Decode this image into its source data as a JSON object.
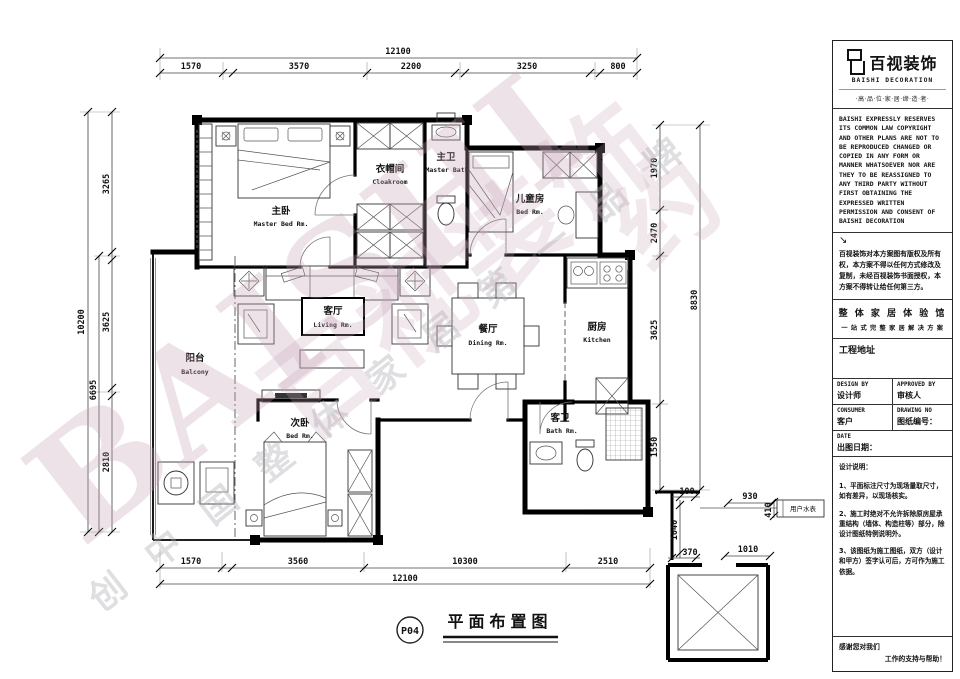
{
  "sheet": {
    "number": "P04",
    "title": "平面布置图"
  },
  "brand": {
    "logo_cn": "百视装饰",
    "logo_en": "BAISHI  DECORATION",
    "tagline": "·高·品·位·家·居·缔·造·者·",
    "copyright_en": "BAISHI EXPRESSLY RESERVES ITS COMMON LAW COPYRIGHT AND OTHER PLANS ARE NOT TO BE REPRODUCED CHANGED OR COPIED IN ANY FORM OR MANNER WHATSOEVER NOR ARE THEY TO BE REASSIGNED TO ANY THIRD PARTY WITHOUT FIRST OBTAINING THE EXPRESSED WRITTEN PERMISSION AND CONSENT OF BAISHI DECORATION",
    "copyright_arrow": "↘",
    "copyright_cn": "百视装饰对本方案图有版权及所有权，本方案不得以任何方式修改及复制，未经百视装饰书面授权，本方案不得转让给任何第三方。",
    "slogan_line1": "整 体 家 居 体 验 馆",
    "slogan_line2": "一 站 式 完 整 家 居 解 决 方 案"
  },
  "title_block": {
    "project_address_label": "工程地址",
    "design_by_label": "DESIGN BY",
    "designer_label": "设计师",
    "approved_by_label": "APPROVED BY",
    "approver_label": "审核人",
    "consumer_label": "CONSUMER",
    "customer_label": "客户",
    "drawing_no_label": "DRAWING NO",
    "drawing_no_cn": "图纸编号：",
    "date_label": "DATE",
    "date_cn": "出图日期：",
    "notes_title": "设计说明：",
    "note1": "1、平面标注尺寸为现场量取尺寸，如有差异，以现场核实。",
    "note2": "2、施工时绝对不允许拆除原房屋承重结构（墙体、构造柱等）部分，除设计图纸特例说明外。",
    "note3": "3、该图纸为施工图纸，双方（设计和甲方）签字认可后，方可作为施工依据。",
    "thanks_line1": "感谢您对我们",
    "thanks_line2": "工作的支持与帮助！"
  },
  "plan": {
    "rooms": {
      "master": {
        "cn": "主卧",
        "en": "Master Bed Rm."
      },
      "cloak": {
        "cn": "衣帽间",
        "en": "Cloakroom"
      },
      "mbath": {
        "cn": "主卫",
        "en": "Master Bath"
      },
      "child": {
        "cn": "儿童房",
        "en": "Bed Rm."
      },
      "living": {
        "cn": "客厅",
        "en": "Living Rm."
      },
      "dining": {
        "cn": "餐厅",
        "en": "Dining Rm."
      },
      "kitchen": {
        "cn": "厨房",
        "en": "Kitchen"
      },
      "balcony": {
        "cn": "阳台",
        "en": "Balcony"
      },
      "bed2": {
        "cn": "次卧",
        "en": "Bed Rm."
      },
      "gbath": {
        "cn": "客卫",
        "en": "Bath Rm."
      }
    },
    "dims": {
      "top_total": "12100",
      "top": [
        "1570",
        "3570",
        "2200",
        "3250",
        "800"
      ],
      "bottom": [
        "1570",
        "3560",
        "10300",
        "2510"
      ],
      "bottom_total": "12100",
      "left": [
        "3265",
        "3625",
        "2810"
      ],
      "left_mid": "6695",
      "left_total": "10200",
      "right": [
        "1970",
        "2470",
        "3625",
        "1550"
      ],
      "right_total": "8830",
      "detail": [
        "100",
        "1040",
        "370",
        "1010",
        "930",
        "410"
      ]
    },
    "annotations": {
      "water_meter": "用户水表"
    }
  },
  "watermark": {
    "brand_en": "BAISHI",
    "brand_cn": "百视装饰",
    "slogan": "创 中 国 整 体 家 居 第 一 品 牌",
    "seal": "约"
  }
}
